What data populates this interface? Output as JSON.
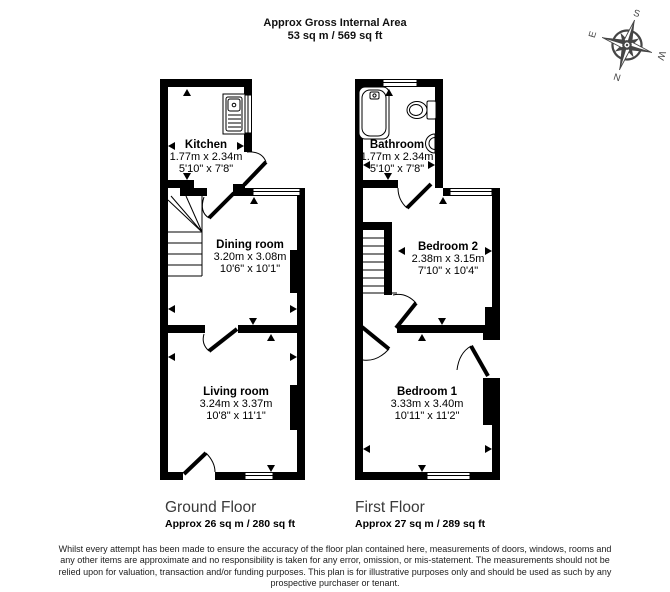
{
  "header": {
    "line1": "Approx Gross Internal Area",
    "line2": "53 sq m / 569 sq ft"
  },
  "compass": {
    "n": "N",
    "s": "S",
    "e": "E",
    "w": "W"
  },
  "floors": {
    "ground": {
      "label": "Ground Floor",
      "area": "Approx 26 sq m / 280 sq ft"
    },
    "first": {
      "label": "First Floor",
      "area": "Approx 27 sq m / 289 sq ft"
    }
  },
  "rooms": {
    "kitchen": {
      "name": "Kitchen",
      "metric": "1.77m x 2.34m",
      "imperial": "5'10\" x 7'8\""
    },
    "dining": {
      "name": "Dining room",
      "metric": "3.20m x 3.08m",
      "imperial": "10'6\" x 10'1\""
    },
    "living": {
      "name": "Living room",
      "metric": "3.24m x 3.37m",
      "imperial": "10'8\" x 11'1\""
    },
    "bathroom": {
      "name": "Bathroom",
      "metric": "1.77m x 2.34m",
      "imperial": "5'10\" x 7'8\""
    },
    "bedroom2": {
      "name": "Bedroom 2",
      "metric": "2.38m x 3.15m",
      "imperial": "7'10\" x 10'4\""
    },
    "bedroom1": {
      "name": "Bedroom 1",
      "metric": "3.33m x 3.40m",
      "imperial": "10'11\" x 11'2\""
    }
  },
  "colors": {
    "wall": "#000000",
    "compass": "#454545"
  },
  "disclaimer": {
    "lines": [
      "Whilst every attempt has been made to ensure the accuracy of the floor plan contained here, measurements of doors, windows, rooms and",
      "any other items are approximate and no responsibility is taken for any error, omission, or mis-statement. The measurements should not be",
      "relied upon for valuation, transaction and/or funding purposes. This plan is for illustrative purposes only and should be used as such by any",
      "prospective purchaser or tenant."
    ]
  }
}
